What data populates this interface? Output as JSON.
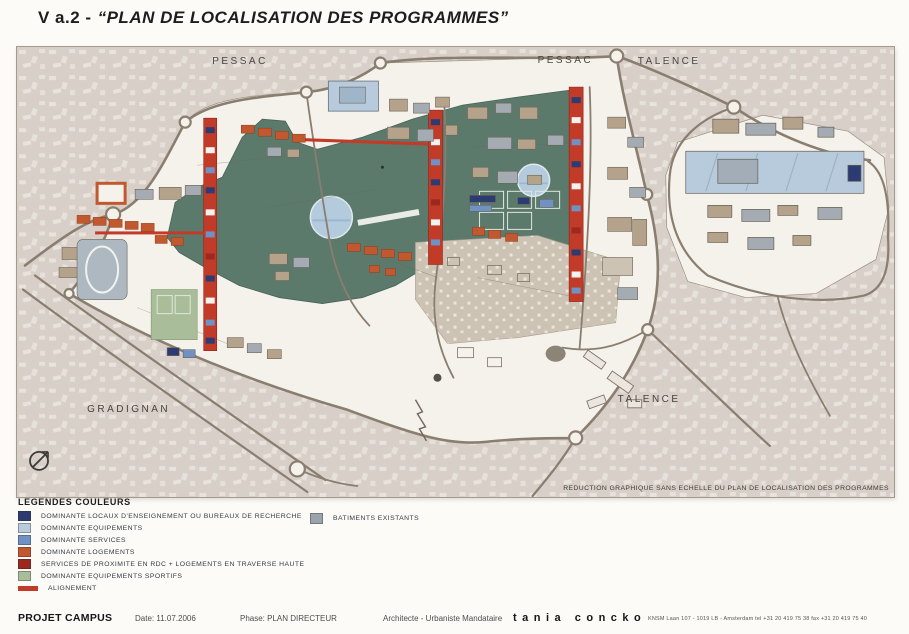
{
  "title": {
    "prefix": "V a.2 -",
    "main": "“PLAN DE LOCALISATION DES PROGRAMMES”"
  },
  "map": {
    "labels": {
      "pessac_nw": "PESSAC",
      "pessac_n": "PESSAC",
      "talence_ne": "TALENCE",
      "gradignan": "GRADIGNAN",
      "talence_se": "TALENCE"
    },
    "note": "REDUCTION GRAPHIQUE SANS ECHELLE DU PLAN DE LOCALISATION DES PROGRAMMES",
    "north_icon": "north-arrow",
    "area_colors": {
      "surrounding_fabric": "#d7cfc8",
      "campus_ground": "#f5f2ec",
      "park_green": "#5b7a6b",
      "pond_blue": "#b3cbdd",
      "wooded_beige": "#cdc3b4",
      "road": "#8a7e70"
    }
  },
  "legend": {
    "heading": "LEGENDES COULEURS",
    "items": [
      {
        "label": "DOMINANTE LOCAUX D'ENSEIGNEMENT OU BUREAUX DE RECHERCHE",
        "color": "#2c3c72"
      },
      {
        "label": "DOMINANTE EQUIPEMENTS",
        "color": "#b7cbdc"
      },
      {
        "label": "DOMINANTE SERVICES",
        "color": "#7091c3"
      },
      {
        "label": "DOMINANTE LOGEMENTS",
        "color": "#c2582f"
      },
      {
        "label": "SERVICES DE PROXIMITE EN RDC + LOGEMENTS EN TRAVERSE HAUTE",
        "color": "#9b291e"
      },
      {
        "label": "DOMINANTE EQUIPEMENTS SPORTIFS",
        "color": "#a9bd9b"
      },
      {
        "label": "ALIGNEMENT",
        "color": "#c13b28"
      }
    ],
    "existing": {
      "label": "BATIMENTS EXISTANTS",
      "color": "#9ba3ad"
    }
  },
  "footer": {
    "project": "PROJET CAMPUS",
    "date": "Date: 11.07.2006",
    "phase": "Phase: PLAN DIRECTEUR",
    "architect_role": "Architecte - Urbaniste Mandataire",
    "architect_name": "tania concko",
    "architect_address": "KNSM Laan 107 - 1019 LB - Amsterdam   tel +31 20 419 75 38   fax +31 20 419 75 40"
  }
}
